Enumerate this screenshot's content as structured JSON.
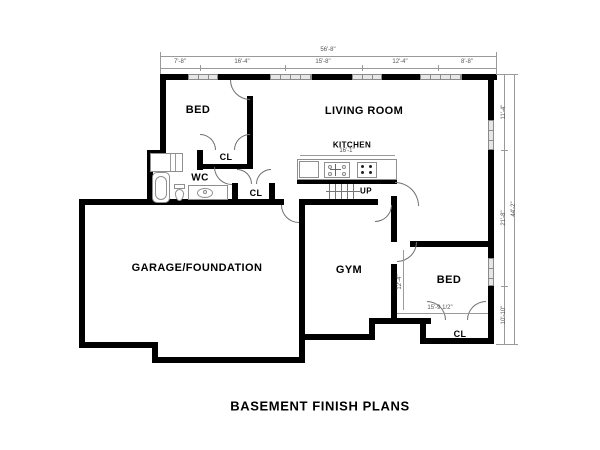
{
  "title": "BASEMENT FINISH PLANS",
  "rooms": {
    "bed_upper": {
      "label": "BED"
    },
    "living_room": {
      "label": "LIVING ROOM"
    },
    "kitchen": {
      "label": "KITCHEN"
    },
    "closet_upper": {
      "label": "CL"
    },
    "wc": {
      "label": "WC"
    },
    "closet_mid": {
      "label": "CL"
    },
    "garage": {
      "label": "GARAGE/FOUNDATION"
    },
    "gym": {
      "label": "GYM"
    },
    "bed_lower": {
      "label": "BED"
    },
    "closet_lower": {
      "label": "CL"
    },
    "stairs": {
      "label": "UP"
    }
  },
  "dimensions": {
    "top_overall": "56'-8\"",
    "top_segments": [
      "7'-8\"",
      "16'-4\"",
      "15'-8\"",
      "12'-4\"",
      "8'-8\""
    ],
    "right_overall": "44'-2\"",
    "right_segments": [
      "11'-4\"",
      "21'-8\"",
      "10'-10\""
    ],
    "kitchen_width": "16'-1\"",
    "bed_lower_width": "15'-9 1/2\"",
    "bed_lower_height": "12'-4\""
  },
  "colors": {
    "wall": "#000000",
    "dimension": "#9a9a9a",
    "window_fill": "#e6e6e6"
  }
}
